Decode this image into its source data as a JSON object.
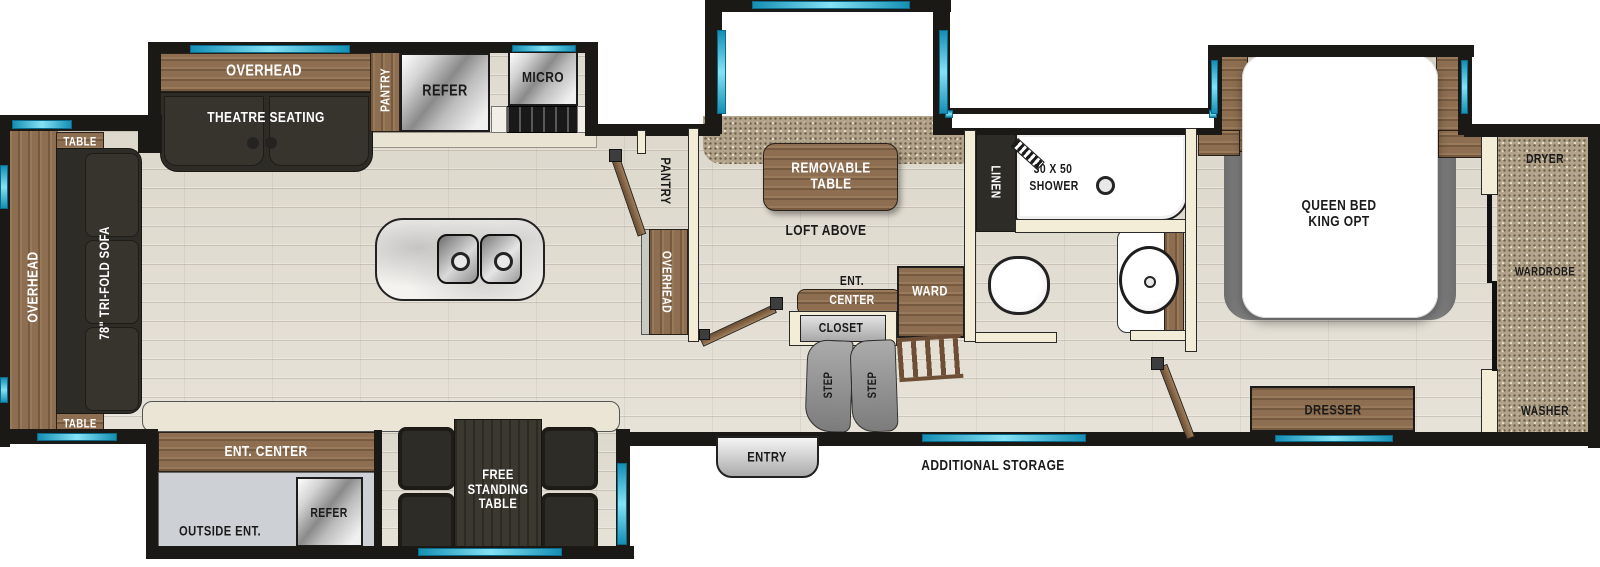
{
  "title": "Fifth wheel RV floorplan",
  "colors": {
    "wall": "#1b1916",
    "window_accent": "#2ab5d8",
    "wood": "#8d6e50",
    "dark_furniture": "#2e2c27",
    "floor": "#e4dfd5",
    "carpet": "#b2a38a",
    "counter": "#ebe5d6",
    "metal": "#c7c7c7"
  },
  "labels": {
    "left_slide": {
      "table_top": "TABLE",
      "overhead": "OVERHEAD",
      "sofa": "78\" TRI-FOLD SOFA",
      "table_bottom": "TABLE"
    },
    "kitchen": {
      "overhead": "OVERHEAD",
      "theatre": "THEATRE SEATING",
      "pantry": "PANTRY",
      "refer": "REFER",
      "micro": "MICRO"
    },
    "sofa_slide": {
      "sofa": "TRI-FOLD SOFA",
      "removable_table": "REMOVABLE TABLE",
      "loft": "LOFT ABOVE"
    },
    "hall": {
      "pantry": "PANTRY",
      "overhead": "OVERHEAD",
      "ent_line1": "ENT.",
      "ent_line2": "CENTER",
      "closet": "CLOSET",
      "ward": "WARD",
      "step": "STEP",
      "entry": "ENTRY",
      "additional_storage": "ADDITIONAL STORAGE"
    },
    "bath": {
      "linen": "LINEN",
      "shower_line1": "30 X 50",
      "shower_line2": "SHOWER"
    },
    "bedroom": {
      "bed_line1": "QUEEN BED",
      "bed_line2": "KING OPT",
      "dresser": "DRESSER"
    },
    "laundry": {
      "dryer": "DRYER",
      "wardrobe": "WARDROBE",
      "washer": "WASHER"
    },
    "bottom_slide": {
      "ent_center": "ENT. CENTER",
      "outside_ent": "OUTSIDE ENT.",
      "refer": "REFER",
      "free_standing_table": "FREE STANDING TABLE"
    }
  }
}
